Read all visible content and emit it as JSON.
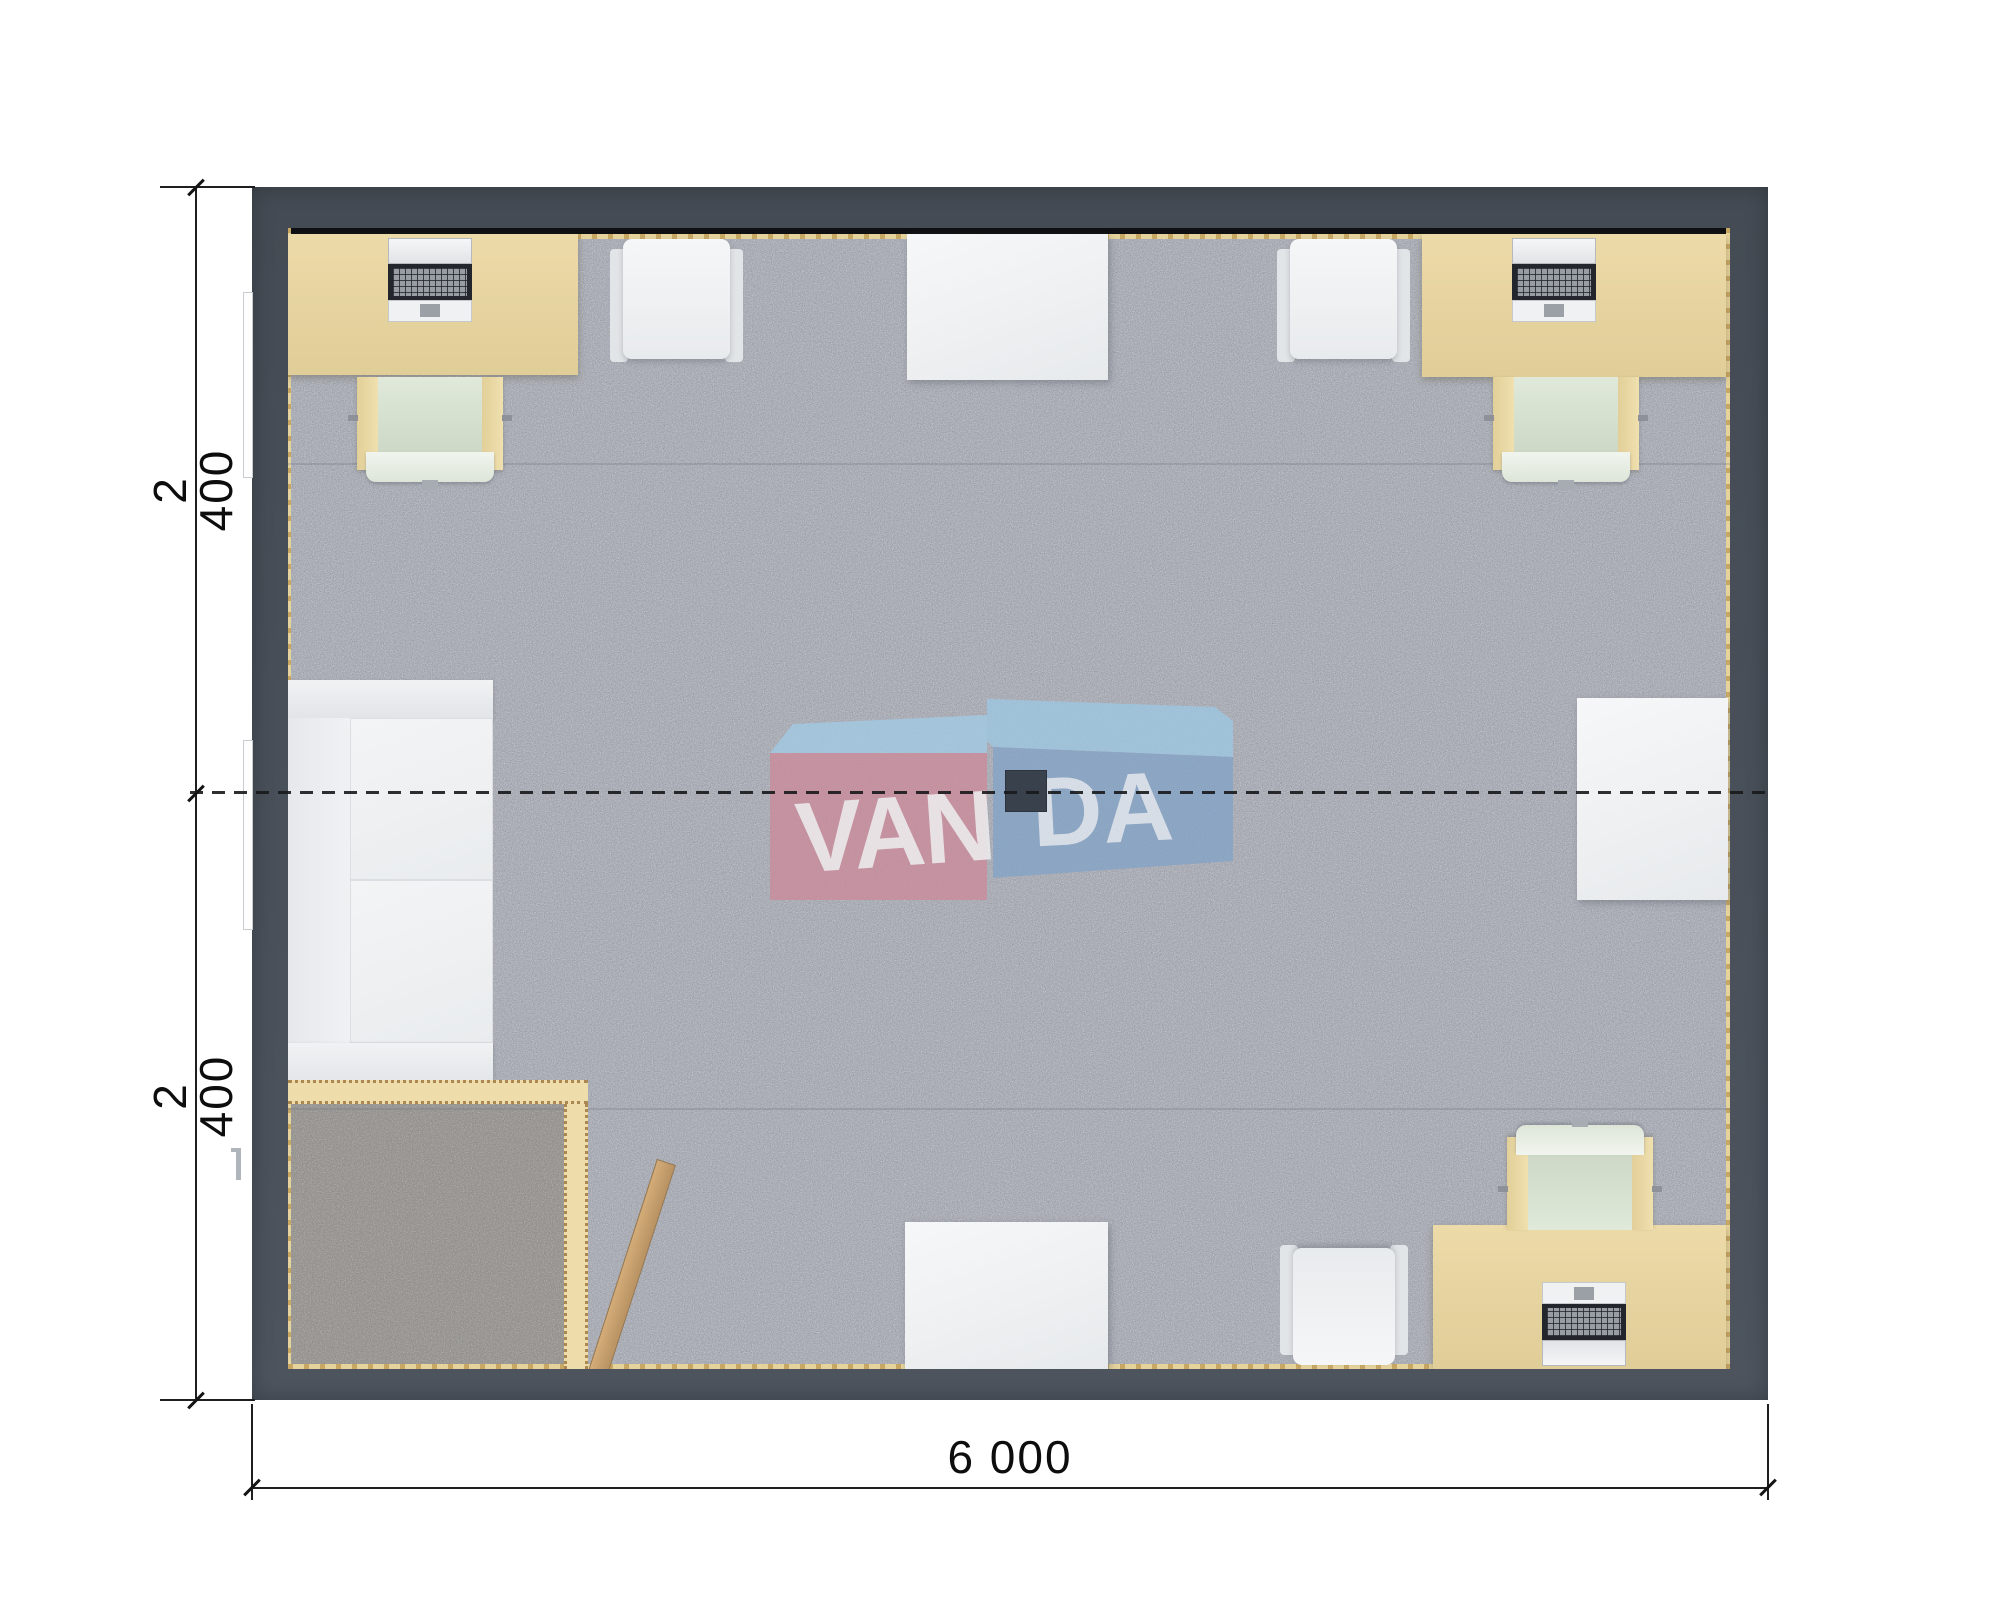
{
  "plan": {
    "title": "modular office floor plan - top view render",
    "dimensions": {
      "left_top": "2 400",
      "left_bottom": "2 400",
      "bottom": "6 000"
    },
    "watermark": {
      "left": "VAN",
      "right": "DA",
      "full": "VANDA"
    },
    "colors": {
      "wall": "#4a515b",
      "carpet": "#b8bbc3",
      "entry_mat": "#a29e96",
      "desk": "#e8d6a3",
      "chair_seat": "#d7e1d1",
      "white_furniture": "#f0f2f4",
      "partition": "#eedcab",
      "door_wood": "#c8a26f",
      "logo_pink": "#cb8c9b",
      "logo_blue": "#84a4c7",
      "logo_light_blue": "#9ec7e2",
      "dimension_lines": "#1f1f1f"
    },
    "furniture_inventory": [
      "desk-with-computer-top-left",
      "office-chair-top-left",
      "armchair-top-left",
      "meeting-table-top",
      "armchair-top-right",
      "desk-with-computer-top-right",
      "office-chair-top-right",
      "sofa-left",
      "entry-partition",
      "entry-door-leaf",
      "side-table-right",
      "ceiling-light-center",
      "table-bottom-center",
      "armchair-bottom",
      "office-chair-bottom-right",
      "desk-with-computer-bottom-right"
    ]
  }
}
